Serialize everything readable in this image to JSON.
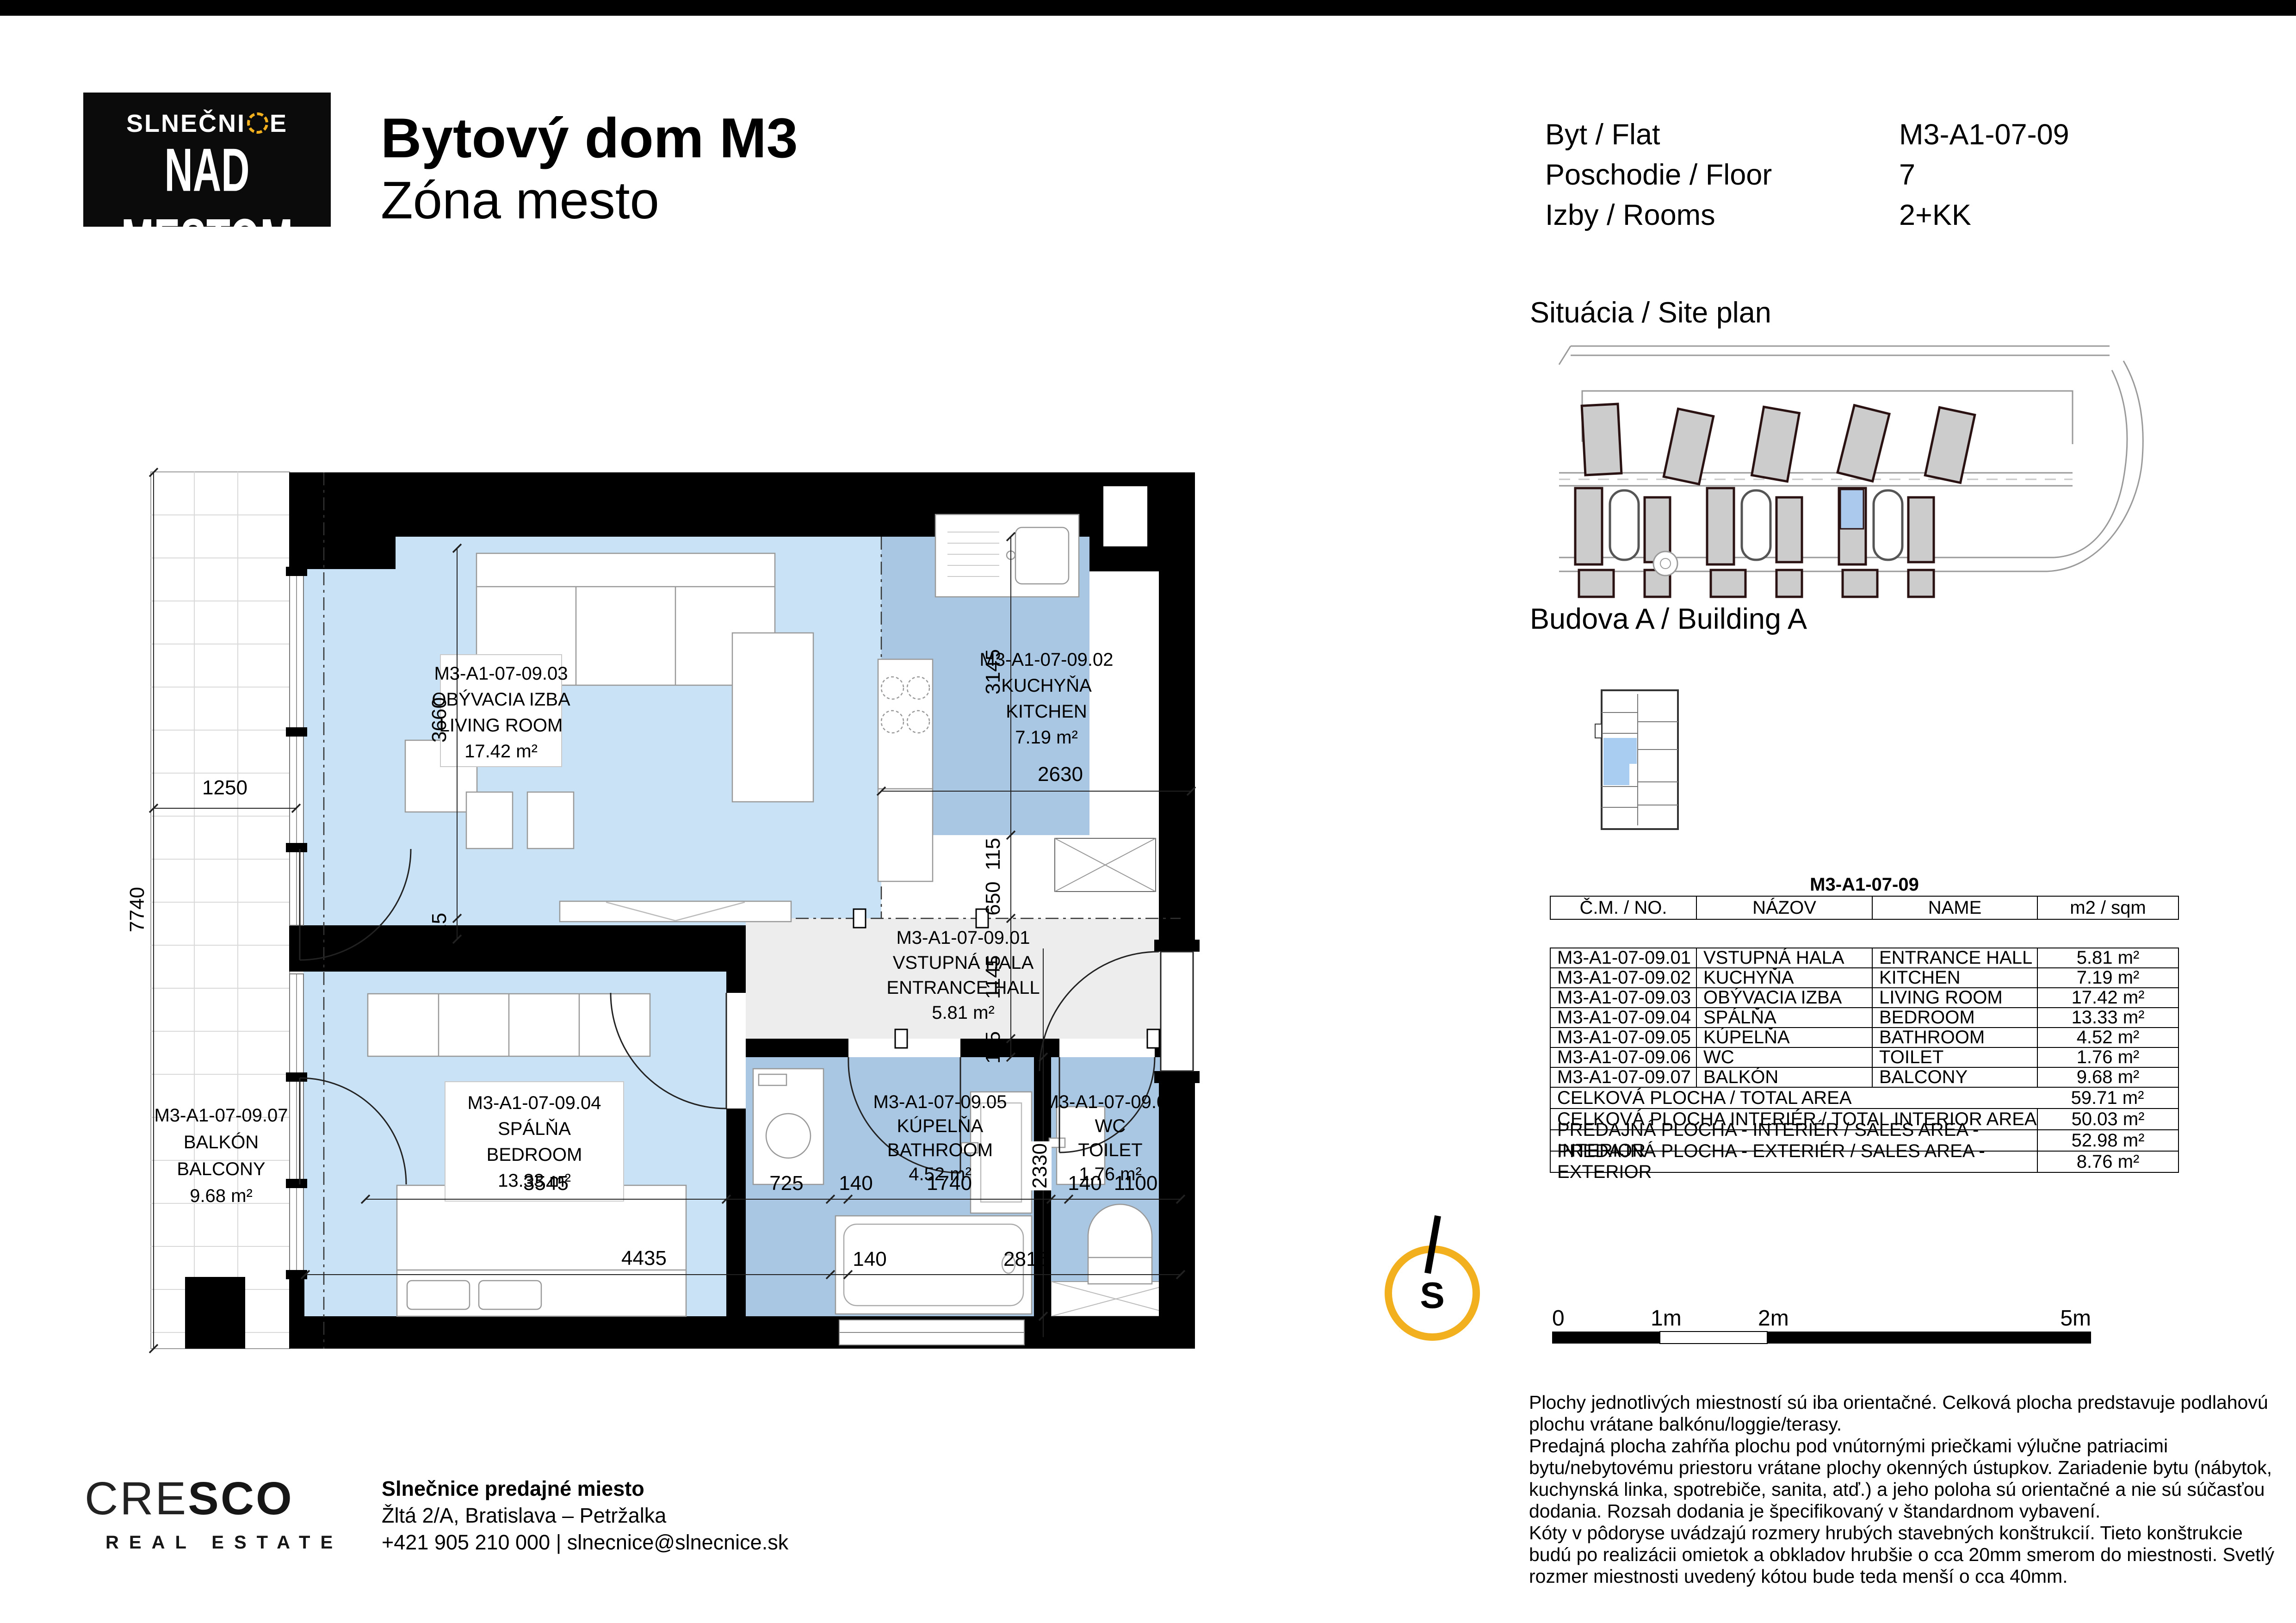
{
  "header": {
    "logo": {
      "name_part1": "SLNEČNI",
      "name_part2": "E",
      "line2": "NAD MESTOM"
    },
    "title_line1": "Bytový dom M3",
    "title_line2": "Zóna mesto",
    "info_rows": [
      {
        "label": "Byt / Flat",
        "value": "M3-A1-07-09"
      },
      {
        "label": "Poschodie / Floor",
        "value": "7"
      },
      {
        "label": "Izby / Rooms",
        "value": "2+KK"
      }
    ]
  },
  "sections": {
    "site_plan": "Situácia / Site plan",
    "building": "Budova A / Building A"
  },
  "table": {
    "title": "M3-A1-07-09",
    "columns": [
      "Č.M. / NO.",
      "NÁZOV",
      "NAME",
      "m2 / sqm"
    ],
    "rows": [
      [
        "M3-A1-07-09.01",
        "VSTUPNÁ HALA",
        "ENTRANCE HALL",
        "5.81 m²"
      ],
      [
        "M3-A1-07-09.02",
        "KUCHYŇA",
        "KITCHEN",
        "7.19 m²"
      ],
      [
        "M3-A1-07-09.03",
        "OBÝVACIA IZBA",
        "LIVING ROOM",
        "17.42 m²"
      ],
      [
        "M3-A1-07-09.04",
        "SPÁLŇA",
        "BEDROOM",
        "13.33 m²"
      ],
      [
        "M3-A1-07-09.05",
        "KÚPELŇA",
        "BATHROOM",
        "4.52 m²"
      ],
      [
        "M3-A1-07-09.06",
        "WC",
        "TOILET",
        "1.76 m²"
      ],
      [
        "M3-A1-07-09.07",
        "BALKÓN",
        "BALCONY",
        "9.68 m²"
      ]
    ],
    "summary": [
      {
        "label": "CELKOVÁ PLOCHA / TOTAL AREA",
        "value": "59.71 m²"
      },
      {
        "label": "CELKOVÁ PLOCHA INTERIÉR / TOTAL INTERIOR AREA",
        "value": "50.03 m²"
      },
      {
        "label": "PREDAJNÁ PLOCHA - INTERIÉR / SALES AREA - INTERIOR",
        "value": "52.98 m²"
      },
      {
        "label": "PREDAJNÁ PLOCHA - EXTERIÉR / SALES AREA - EXTERIOR",
        "value": "8.76 m²"
      }
    ]
  },
  "plan": {
    "rooms": [
      {
        "id": "M3-A1-07-09.01",
        "sk": "VSTUPNÁ HALA",
        "en": "ENTRANCE HALL",
        "area": "5.81 m²"
      },
      {
        "id": "M3-A1-07-09.02",
        "sk": "KUCHYŇA",
        "en": "KITCHEN",
        "area": "7.19 m²"
      },
      {
        "id": "M3-A1-07-09.03",
        "sk": "OBÝVACIA IZBA",
        "en": "LIVING ROOM",
        "area": "17.42 m²"
      },
      {
        "id": "M3-A1-07-09.04",
        "sk": "SPÁLŇA",
        "en": "BEDROOM",
        "area": "13.33 m²"
      },
      {
        "id": "M3-A1-07-09.05",
        "sk": "KÚPELŇA",
        "en": "BATHROOM",
        "area": "4.52 m²"
      },
      {
        "id": "M3-A1-07-09.06",
        "sk": "WC",
        "en": "TOILET",
        "area": "1.76 m²"
      },
      {
        "id": "M3-A1-07-09.07",
        "sk": "BALKÓN",
        "en": "BALCONY",
        "area": "9.68 m²"
      }
    ],
    "dims": [
      {
        "text": "1250"
      },
      {
        "text": "7740"
      },
      {
        "text": "3660"
      },
      {
        "text": "115"
      },
      {
        "text": "3145"
      },
      {
        "text": "115"
      },
      {
        "text": "650"
      },
      {
        "text": "1145"
      },
      {
        "text": "115"
      },
      {
        "text": "2630"
      },
      {
        "text": "3545"
      },
      {
        "text": "725"
      },
      {
        "text": "140"
      },
      {
        "text": "1740"
      },
      {
        "text": "2330"
      },
      {
        "text": "140"
      },
      {
        "text": "1100"
      },
      {
        "text": "4435"
      },
      {
        "text": "140"
      },
      {
        "text": "2815"
      }
    ]
  },
  "north": {
    "label": "S"
  },
  "scalebar": {
    "labels": [
      "0",
      "1m",
      "2m",
      "5m"
    ]
  },
  "disclaimer": {
    "lines": [
      "Plochy jednotlivých miestností sú iba orientačné. Celková plocha predstavuje podlahovú",
      "plochu vrátane balkónu/loggie/terasy.",
      "Predajná plocha zahŕňa plochu pod vnútornými priečkami výlučne patriacimi",
      "bytu/nebytovému priestoru vrátane plochy okenných ústupkov. Zariadenie bytu (nábytok,",
      "kuchynská linka, spotrebiče, sanita, atď.) a jeho poloha sú orientačné a nie sú súčasťou",
      "dodania. Rozsah dodania je špecifikovaný v štandardnom vybavení.",
      "Kóty v pôdoryse uvádzajú rozmery hrubých stavebných konštrukcií. Tieto konštrukcie",
      "budú po realizácii omietok a obkladov hrubšie o cca 20mm smerom do miestnosti. Svetlý",
      "rozmer miestnosti uvedený kótou bude teda menší o cca 40mm."
    ]
  },
  "footer": {
    "cresco_light": "CRE",
    "cresco_bold": "SCO",
    "cresco_sub": "REAL ESTATE",
    "contact_line1": "Slnečnice predajné miesto",
    "contact_line2": "Žltá 2/A, Bratislava – Petržalka",
    "contact_line3": "+421 905 210 000 | slnecnice@slnecnice.sk"
  },
  "colors": {
    "room_light": "#c9e2f5",
    "room_medium": "#a9c6e2",
    "hall_gray": "#ededed",
    "accent_yellow": "#f2b01e"
  }
}
